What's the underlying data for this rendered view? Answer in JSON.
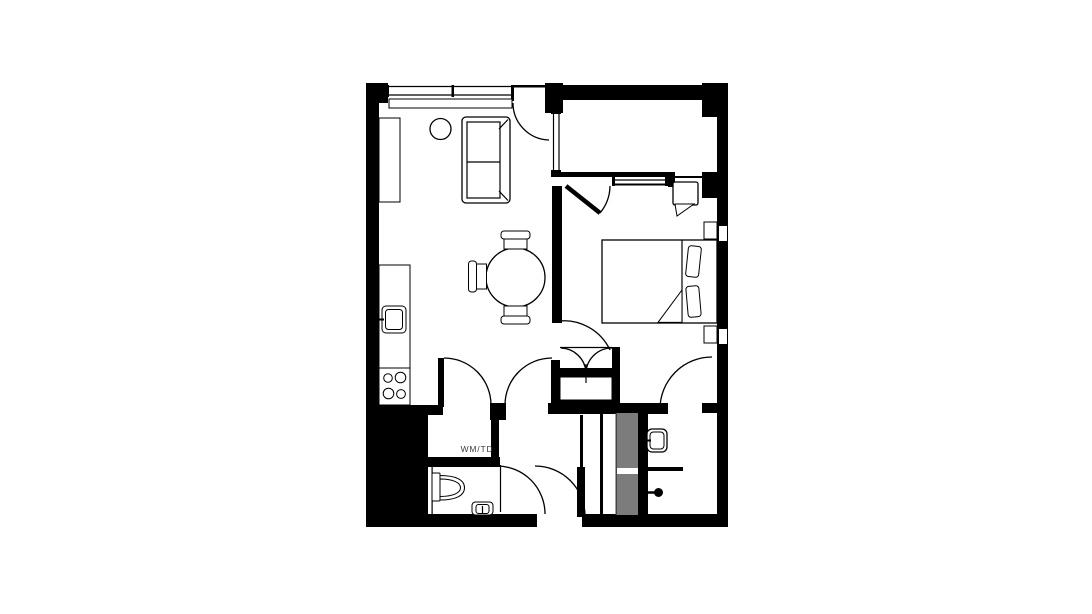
{
  "floorplan": {
    "laundry_label": "WM/TD",
    "colors": {
      "wall": "#000000",
      "shaft_gray": "#7c7c7c",
      "background": "#ffffff",
      "label_text": "#3d3d3d"
    },
    "rooms": [
      {
        "name": "living-kitchen"
      },
      {
        "name": "bedroom"
      },
      {
        "name": "balcony"
      },
      {
        "name": "wc-bathroom"
      },
      {
        "name": "shower-room"
      },
      {
        "name": "laundry-closet",
        "label": "WM/TD"
      },
      {
        "name": "wardrobe-closet"
      },
      {
        "name": "entry-vestibule"
      }
    ],
    "fixtures": [
      "sofa",
      "round-side-table",
      "dining-table",
      "dining-chair",
      "tall-cabinet",
      "kitchen-counter",
      "kitchen-sink",
      "stove-burners",
      "bed",
      "pillow",
      "nightstand",
      "armchair-with-throw",
      "toilet",
      "hand-basin",
      "washbasin",
      "shower-head",
      "utility-shaft"
    ]
  }
}
